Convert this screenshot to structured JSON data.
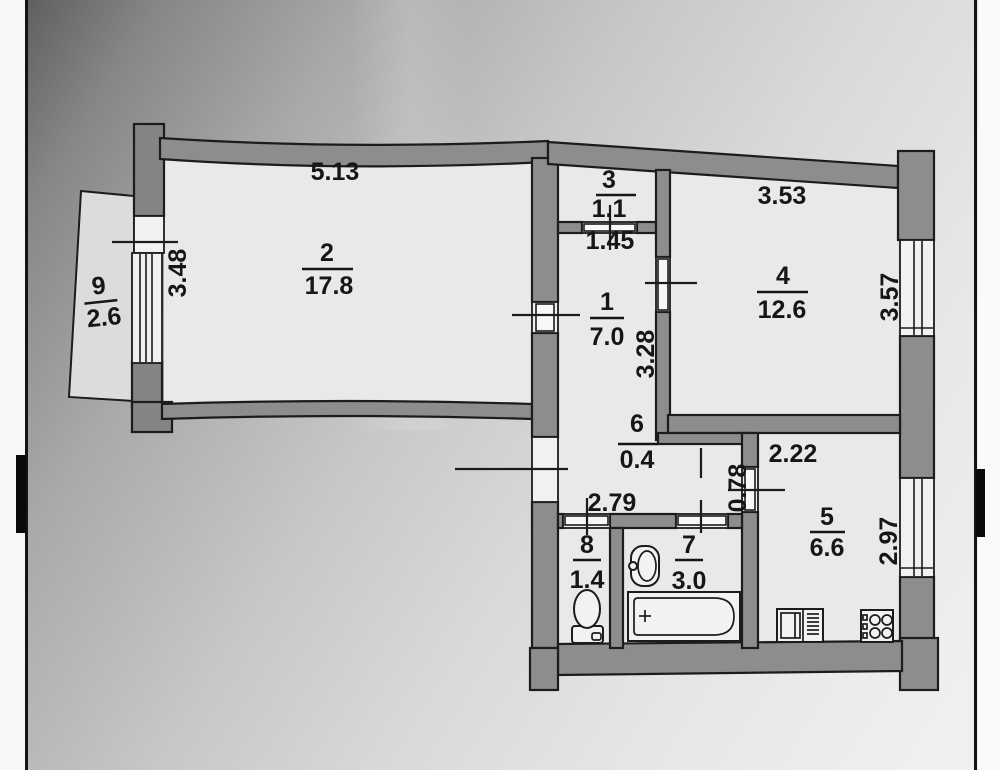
{
  "plan_title": "apartment floor plan",
  "rooms": {
    "1": {
      "num": "1",
      "area": "7.0"
    },
    "2": {
      "num": "2",
      "area": "17.8"
    },
    "3": {
      "num": "3",
      "area": "1.1"
    },
    "4": {
      "num": "4",
      "area": "12.6"
    },
    "5": {
      "num": "5",
      "area": "6.6"
    },
    "6": {
      "num": "6",
      "area": "0.4"
    },
    "7": {
      "num": "7",
      "area": "3.0"
    },
    "8": {
      "num": "8",
      "area": "1.4"
    },
    "9": {
      "num": "9",
      "area": "2.6"
    }
  },
  "dims": {
    "room2_top": "5.13",
    "room2_left": "3.48",
    "room3_door": "1.45",
    "room1_right": "3.28",
    "room4_top": "3.53",
    "room4_right": "3.57",
    "hall_bottom": "2.79",
    "kitchen_door": "0.78",
    "kitchen_top": "2.22",
    "kitchen_right": "2.97"
  },
  "icons": {
    "toilet": "toilet-icon",
    "wash_basin": "sink-icon",
    "bathtub": "bathtub-icon",
    "kitchen_sink": "kitchen-sink-icon",
    "stove": "stove-icon"
  },
  "colors": {
    "wall": "#8d8d8d",
    "line": "#1c1c1c",
    "room_fill": "#e9e9e9",
    "paper_dark": "#5f5f5f",
    "paper_light": "#eeeeee"
  }
}
